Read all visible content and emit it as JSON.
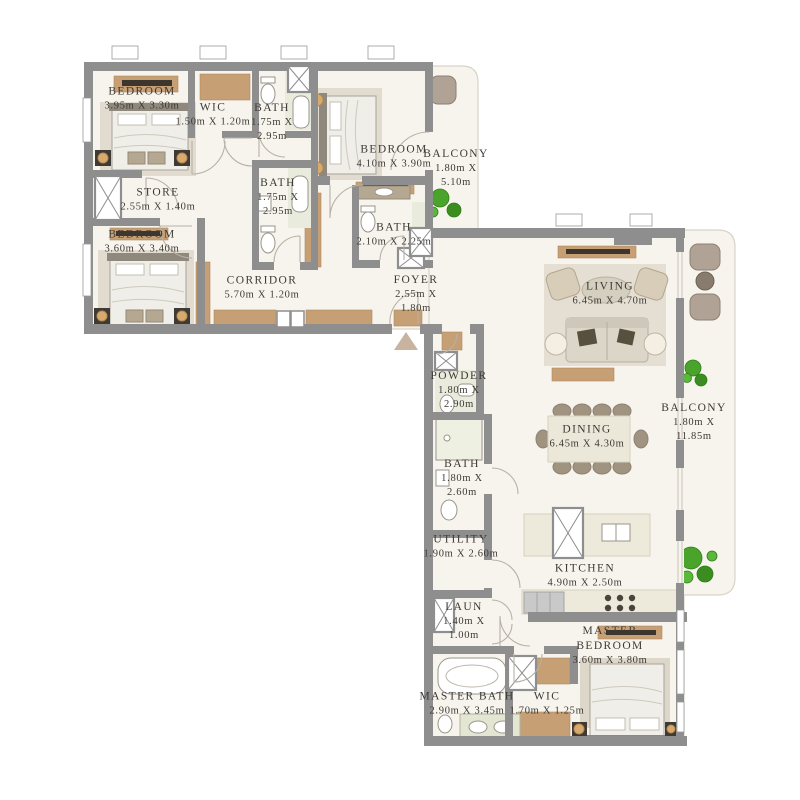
{
  "plan": {
    "title": "apartment-floor-plan",
    "rooms": [
      {
        "name": "BEDROOM",
        "dims": "3.95m X 3.30m"
      },
      {
        "name": "WIC",
        "dims": "1.50m X 1.20m"
      },
      {
        "name": "BATH",
        "dims": "1.75m X\n2.95m"
      },
      {
        "name": "BEDROOM",
        "dims": "4.10m X 3.90m"
      },
      {
        "name": "BALCONY",
        "dims": "1.80m X\n5.10m"
      },
      {
        "name": "STORE",
        "dims": "2.55m X 1.40m"
      },
      {
        "name": "BEDROOM",
        "dims": "3.60m X 3.40m"
      },
      {
        "name": "BATH",
        "dims": "1.75m X\n2.95m"
      },
      {
        "name": "BATH",
        "dims": "2.10m X 2.25m"
      },
      {
        "name": "CORRIDOR",
        "dims": "5.70m X 1.20m"
      },
      {
        "name": "FOYER",
        "dims": "2.55m X\n1.80m"
      },
      {
        "name": "LIVING",
        "dims": "6.45m X 4.70m"
      },
      {
        "name": "POWDER",
        "dims": "1.80m X\n2.90m"
      },
      {
        "name": "DINING",
        "dims": "6.45m X 4.30m"
      },
      {
        "name": "BALCONY",
        "dims": "1.80m X\n11.85m"
      },
      {
        "name": "BATH",
        "dims": "1.80m X\n2.60m"
      },
      {
        "name": "UTILITY",
        "dims": "1.90m X 2.60m"
      },
      {
        "name": "KITCHEN",
        "dims": "4.90m X 2.50m"
      },
      {
        "name": "LAUN",
        "dims": "1.40m X\n1.00m"
      },
      {
        "name": "MASTER\nBEDROOM",
        "dims": "3.60m X 3.80m"
      },
      {
        "name": "MASTER BATH",
        "dims": "2.90m X 3.45m"
      },
      {
        "name": "WIC",
        "dims": "1.70m X 1.25m"
      }
    ],
    "colors": {
      "wall": "#8e8e8e",
      "floor": "#f7f4ee",
      "wood": "#c79f74",
      "rug": "#e3ddd1",
      "tile": "#e9ecdc",
      "counter": "#edeadb",
      "plant": "#4aa32a",
      "arrow": "#c8b49e",
      "text": "#3d3a35"
    }
  }
}
